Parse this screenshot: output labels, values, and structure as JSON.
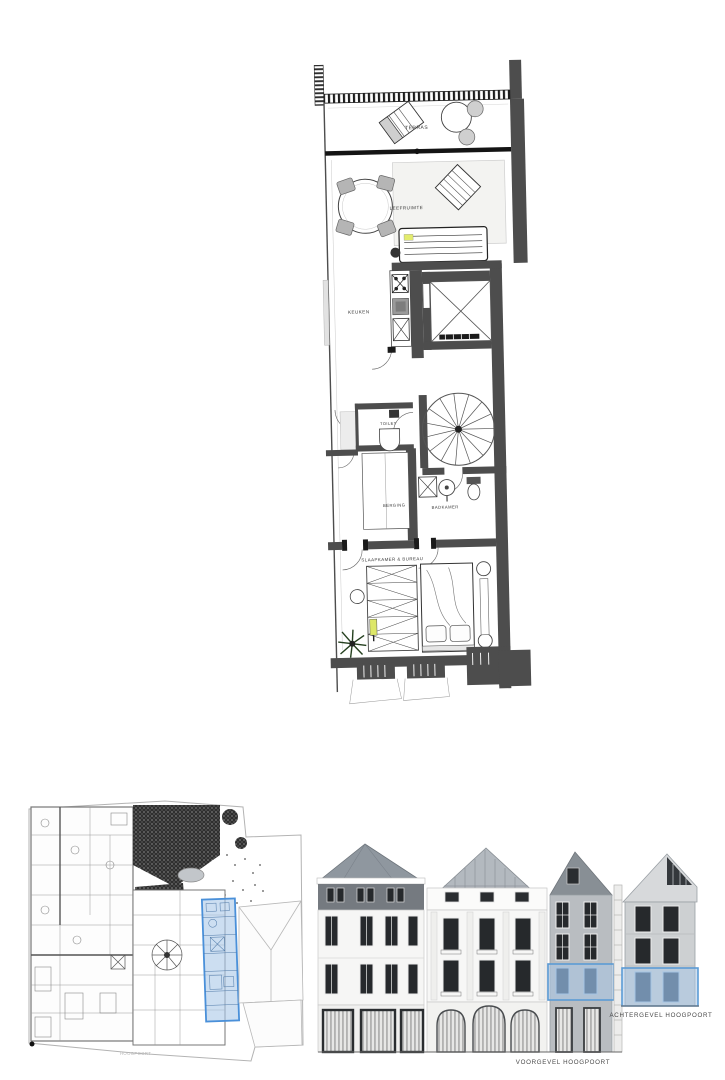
{
  "floor_plan": {
    "rooms": {
      "terras": "TERRAS",
      "leefruimte": "LEEFRUIMTE",
      "keuken": "KEUKEN",
      "toilet": "TOILET",
      "berging": "BERGING",
      "badkamer": "BADKAMER",
      "slaapkamer": "SLAAPKAMER & BUREAU"
    }
  },
  "site_plan": {
    "caption": "HOOGPOORT"
  },
  "elevations": {
    "front_caption": "VOORGEVEL HOOGPOORT",
    "rear_caption": "ACHTERGEVEL HOOGPOORT"
  },
  "colors": {
    "wall": "#4d4d4d",
    "highlight_fill": "#A9C7E6",
    "highlight_border": "#5B9BD5",
    "roof_gray": "#8F979F",
    "facade_white": "#F6F6F5",
    "facade_gray": "#B9BDC1",
    "window_dark": "#26292C"
  }
}
